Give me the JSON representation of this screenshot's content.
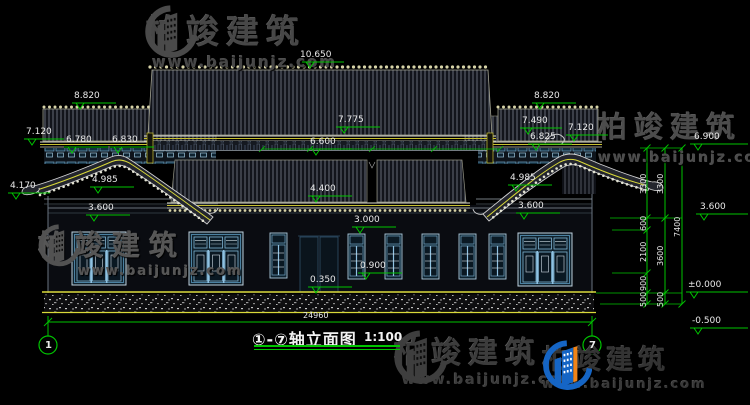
{
  "watermarks": {
    "brand": "柏竣建筑",
    "url": "www.baijunjz.com"
  },
  "title": {
    "axes": "①-⑦",
    "name": "轴立面图",
    "scale": "1:100"
  },
  "axis_bubbles": [
    {
      "label": "1"
    },
    {
      "label": "7"
    }
  ],
  "elevation_marks": [
    {
      "text": "10.650",
      "x": 300,
      "y": 51,
      "bar": [
        302,
        344,
        62
      ],
      "tri": 306
    },
    {
      "text": "8.820",
      "x": 74,
      "y": 92,
      "bar": [
        72,
        116,
        103
      ],
      "tri": 76
    },
    {
      "text": "7.120",
      "x": 26,
      "y": 128,
      "bar": [
        24,
        64,
        139
      ],
      "tri": 28
    },
    {
      "text": "6.780",
      "x": 66,
      "y": 136,
      "bar": [
        64,
        108,
        147
      ],
      "tri": 68
    },
    {
      "text": "6.830",
      "x": 112,
      "y": 136,
      "bar": [
        110,
        154,
        147
      ],
      "tri": 114
    },
    {
      "text": "4.985",
      "x": 92,
      "y": 176,
      "bar": [
        90,
        134,
        187
      ],
      "tri": 94
    },
    {
      "text": "4.170",
      "x": 10,
      "y": 182,
      "bar": [
        8,
        50,
        193
      ],
      "tri": 12
    },
    {
      "text": "3.600",
      "x": 88,
      "y": 204,
      "bar": [
        86,
        130,
        215
      ],
      "tri": 90
    },
    {
      "text": "7.775",
      "x": 338,
      "y": 116,
      "bar": [
        336,
        380,
        127
      ],
      "tri": 340
    },
    {
      "text": "6.600",
      "x": 310,
      "y": 138,
      "bar": [
        308,
        352,
        149
      ],
      "tri": 312
    },
    {
      "text": "4.400",
      "x": 310,
      "y": 185,
      "bar": [
        308,
        352,
        196
      ],
      "tri": 312
    },
    {
      "text": "3.000",
      "x": 354,
      "y": 216,
      "bar": [
        352,
        396,
        227
      ],
      "tri": 356
    },
    {
      "text": "0.900",
      "x": 360,
      "y": 262,
      "bar": [
        358,
        402,
        273
      ],
      "tri": 362
    },
    {
      "text": "0.350",
      "x": 310,
      "y": 276,
      "bar": [
        308,
        352,
        287
      ],
      "tri": 312
    },
    {
      "text": "8.820",
      "x": 534,
      "y": 92,
      "bar": [
        532,
        576,
        103
      ],
      "tri": 536
    },
    {
      "text": "7.490",
      "x": 522,
      "y": 117,
      "bar": [
        520,
        562,
        128
      ],
      "tri": 524
    },
    {
      "text": "7.120",
      "x": 568,
      "y": 124,
      "bar": [
        566,
        608,
        135
      ],
      "tri": 570
    },
    {
      "text": "6.825",
      "x": 530,
      "y": 133,
      "bar": [
        528,
        572,
        144
      ],
      "tri": 532
    },
    {
      "text": "4.985",
      "x": 510,
      "y": 174,
      "bar": [
        508,
        552,
        185
      ],
      "tri": 512
    },
    {
      "text": "3.600",
      "x": 518,
      "y": 202,
      "bar": [
        516,
        560,
        213
      ],
      "tri": 520
    },
    {
      "text": "6.900",
      "x": 694,
      "y": 133,
      "bar": [
        690,
        748,
        144
      ],
      "tri": 694
    },
    {
      "text": "3.600",
      "x": 700,
      "y": 203,
      "bar": [
        696,
        748,
        214
      ],
      "tri": 700
    },
    {
      "text": "±0.000",
      "x": 688,
      "y": 281,
      "bar": [
        686,
        748,
        292
      ],
      "tri": 690
    },
    {
      "text": "-0.500",
      "x": 692,
      "y": 317,
      "bar": [
        690,
        748,
        328
      ],
      "tri": 694
    }
  ],
  "chain_dims": [
    {
      "text": "3300",
      "x": 640,
      "y": 194,
      "rot": true
    },
    {
      "text": "3300",
      "x": 657,
      "y": 194,
      "rot": true
    },
    {
      "text": "600",
      "x": 640,
      "y": 231,
      "rot": true
    },
    {
      "text": "2100",
      "x": 640,
      "y": 262,
      "rot": true
    },
    {
      "text": "3600",
      "x": 657,
      "y": 266,
      "rot": true
    },
    {
      "text": "900",
      "x": 640,
      "y": 291,
      "rot": true
    },
    {
      "text": "500",
      "x": 640,
      "y": 307,
      "rot": true
    },
    {
      "text": "500",
      "x": 657,
      "y": 307,
      "rot": true
    },
    {
      "text": "7400",
      "x": 674,
      "y": 237,
      "rot": true
    },
    {
      "text": "24960",
      "x": 303,
      "y": 312,
      "rot": false
    }
  ],
  "colors": {
    "dim_green": "#00c400",
    "cad_yellow": "#d9d93a",
    "text_white": "#e9e9e9",
    "window_blue": "#7fb3d2"
  }
}
